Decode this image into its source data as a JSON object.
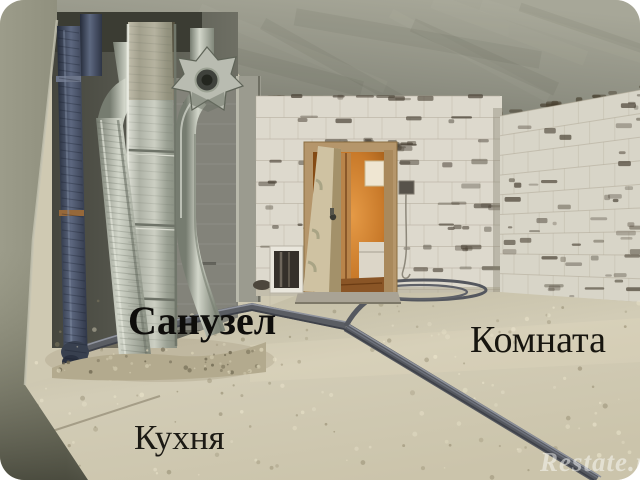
{
  "image": {
    "type": "photograph",
    "subject": "Unfinished apartment interior (bare aerated-concrete block walls, riser pipes, ventilation duct, open door with lit hallway, screed floor with heating pipes), rooms annotated in Russian"
  },
  "labels": {
    "bathroom": "Санузел",
    "room": "Комната",
    "kitchen": "Кухня"
  },
  "watermark": {
    "text": "Restate.ru"
  },
  "palette": {
    "ceiling": "#94958a",
    "block_wall": "#dcd8cc",
    "floor_screed": "#cfc8b0",
    "left_wall": "#95957f",
    "door_light": "#cc7c2e",
    "pipes_dark": "#3a4252",
    "metal_duct": "#b5b8ae"
  }
}
